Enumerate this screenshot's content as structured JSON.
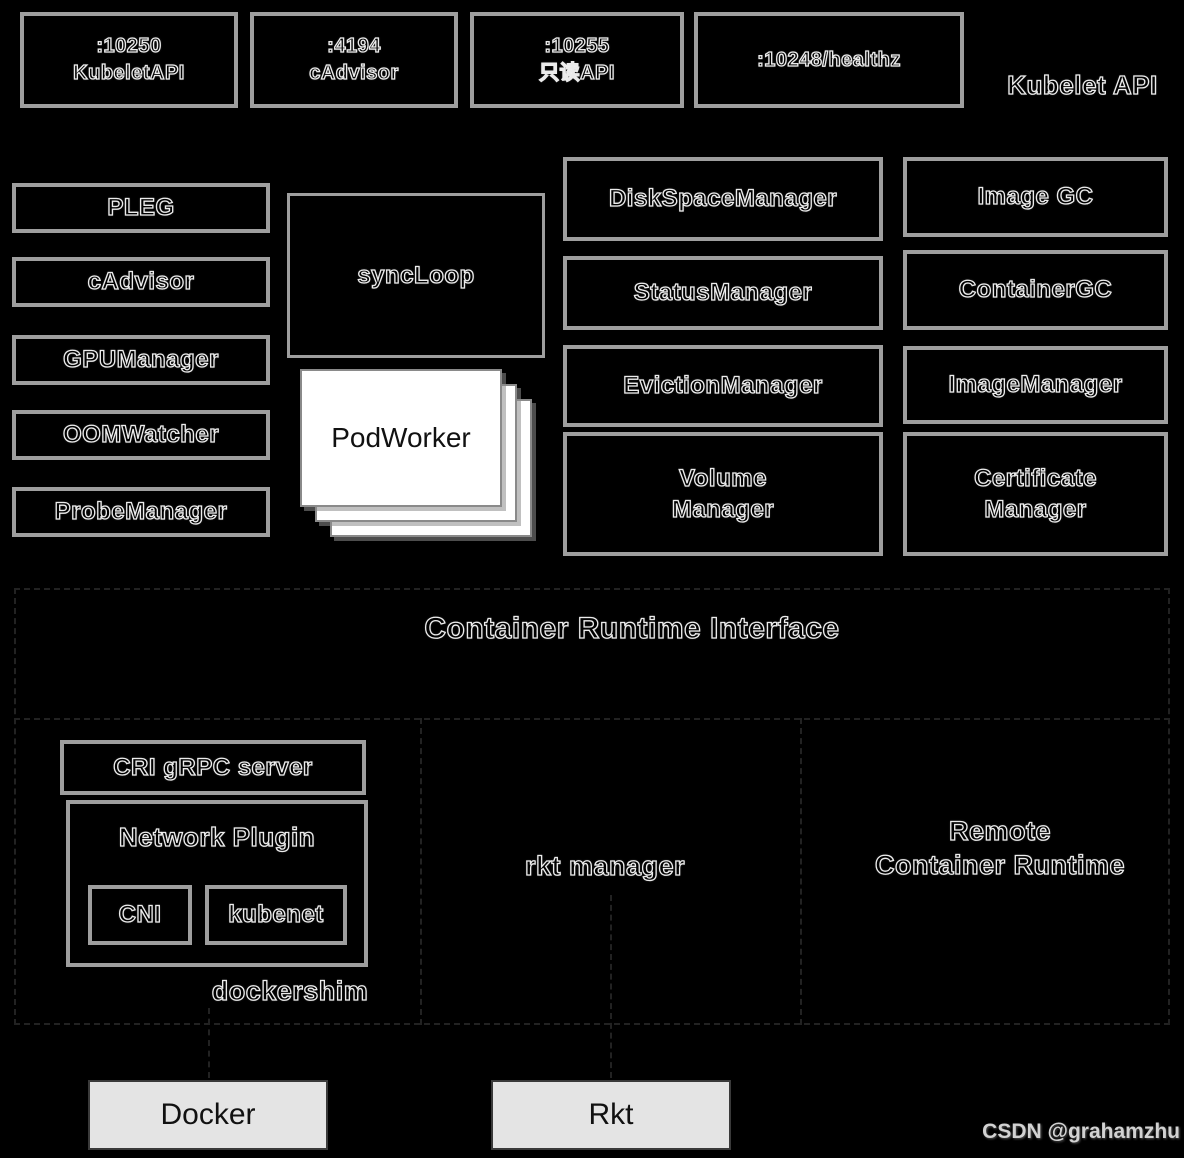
{
  "header": {
    "label": "Kubelet API",
    "ports": [
      {
        "line1": ":10250",
        "line2": "KubeletAPI"
      },
      {
        "line1": ":4194",
        "line2": "cAdvisor"
      },
      {
        "line1": ":10255",
        "line2": "只读API"
      },
      {
        "line1": ":10248/healthz",
        "line2": ""
      }
    ]
  },
  "core": {
    "left": [
      "PLEG",
      "cAdvisor",
      "GPUManager",
      "OOMWatcher",
      "ProbeManager"
    ],
    "syncloop": "syncLoop",
    "podworker": "PodWorker",
    "middle": [
      "DiskSpaceManager",
      "StatusManager",
      "EvictionManager",
      "Volume\nManager"
    ],
    "right": [
      "Image GC",
      "ContainerGC",
      "ImageManager",
      "Certificate\nManager"
    ]
  },
  "cri": {
    "title": "Container Runtime Interface"
  },
  "runtimes": {
    "cri_grpc_server": "CRI gRPC server",
    "network_plugin": "Network Plugin",
    "cni": "CNI",
    "kubenet": "kubenet",
    "dockershim": "dockershim",
    "rkt_manager": "rkt manager",
    "remote": "Remote\nContainer Runtime",
    "docker": "Docker",
    "rkt": "Rkt"
  },
  "watermark": "CSDN @grahamzhu",
  "colors": {
    "background": "#000000",
    "box_border": "#9e9e9e",
    "card_fill": "#ffffff",
    "runtime_fill": "#e4e4e4",
    "watermark_text": "#d2d2d2"
  }
}
